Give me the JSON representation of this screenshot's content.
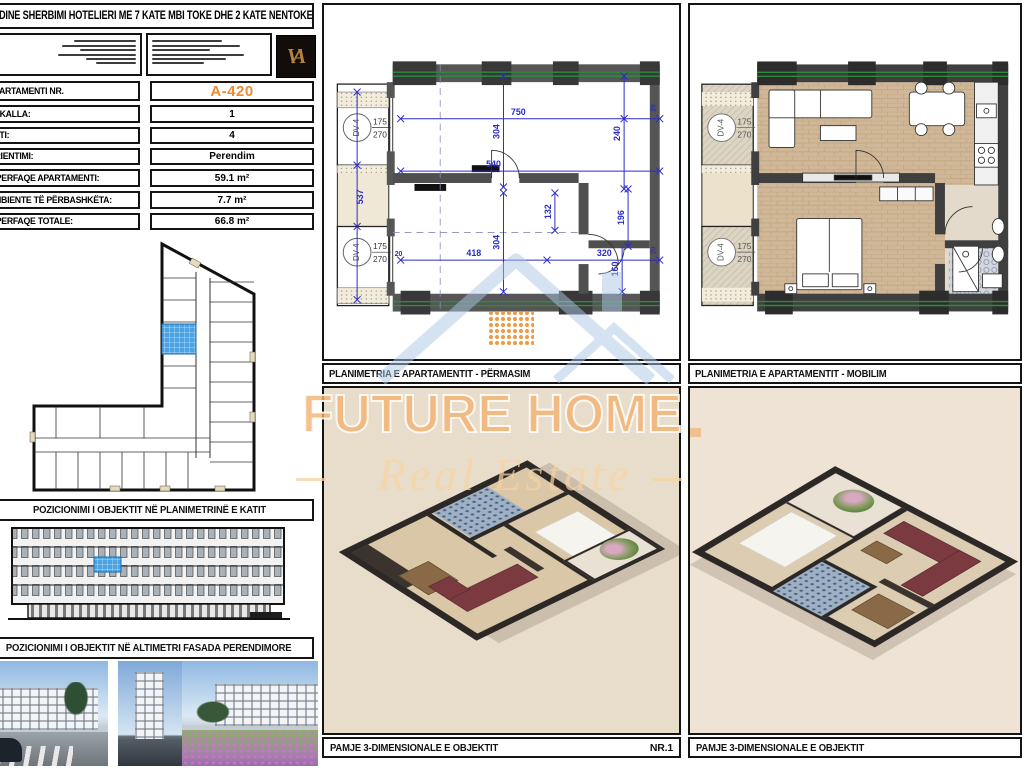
{
  "header": {
    "title": "GODINE SHERBIMI HOTELIERI ME 7 KATE MBI TOKE DHE 2 KATE NENTOKE",
    "logo_monogram": "VA"
  },
  "apartment": {
    "rows": [
      {
        "label": "APARTAMENTI NR.",
        "value": "A-420"
      },
      {
        "label": "SHKALLA:",
        "value": "1"
      },
      {
        "label": "KATI:",
        "value": "4"
      },
      {
        "label": "ORIENTIMI:",
        "value": "Perendim"
      },
      {
        "label": "SIPERFAQE APARTAMENTI:",
        "value": "59.1 m²"
      },
      {
        "label": "AMBIENTE TË PËRBASHKËTA:",
        "value": "7.7 m²"
      },
      {
        "label": "SIPERFAQE TOTALE:",
        "value": "66.8 m²"
      }
    ]
  },
  "sections": {
    "keyplan_title": "POZICIONIMI I OBJEKTIT NË PLANIMETRINË E KATIT",
    "elevation_title": "POZICIONIMI I OBJEKTIT NË ALTIMETRI FASADA PERENDIMORE",
    "plan_dim_title": "PLANIMETRIA E APARTAMENTIT - PËRMASIM",
    "plan_furn_title": "PLANIMETRIA E APARTAMENTIT - MOBILIM",
    "view3d_title_1": "PAMJE 3-DIMENSIONALE E OBJEKTIT",
    "view3d_number": "NR.1",
    "view3d_title_2": "PAMJE 3-DIMENSIONALE E OBJEKTIT"
  },
  "plan": {
    "door_label": "DV-4",
    "door_width": "175",
    "door_height": "270",
    "dims": {
      "top": "750",
      "room_h": "304",
      "mid": "540",
      "right_top": "240",
      "shaft": "537",
      "bottom_left": "418",
      "bottom_right": "320",
      "hall": "132",
      "bath": "196",
      "wc": "160",
      "wall": "20"
    }
  },
  "watermark": {
    "brand": "FUTURE HOME",
    "tagline": "Real Estate"
  },
  "colors": {
    "accent_orange": "#ED8B33",
    "dimension_blue": "#2B2BC8",
    "unit_highlight_blue": "#4BA3E3",
    "facade_green": "#2E8B3D"
  }
}
